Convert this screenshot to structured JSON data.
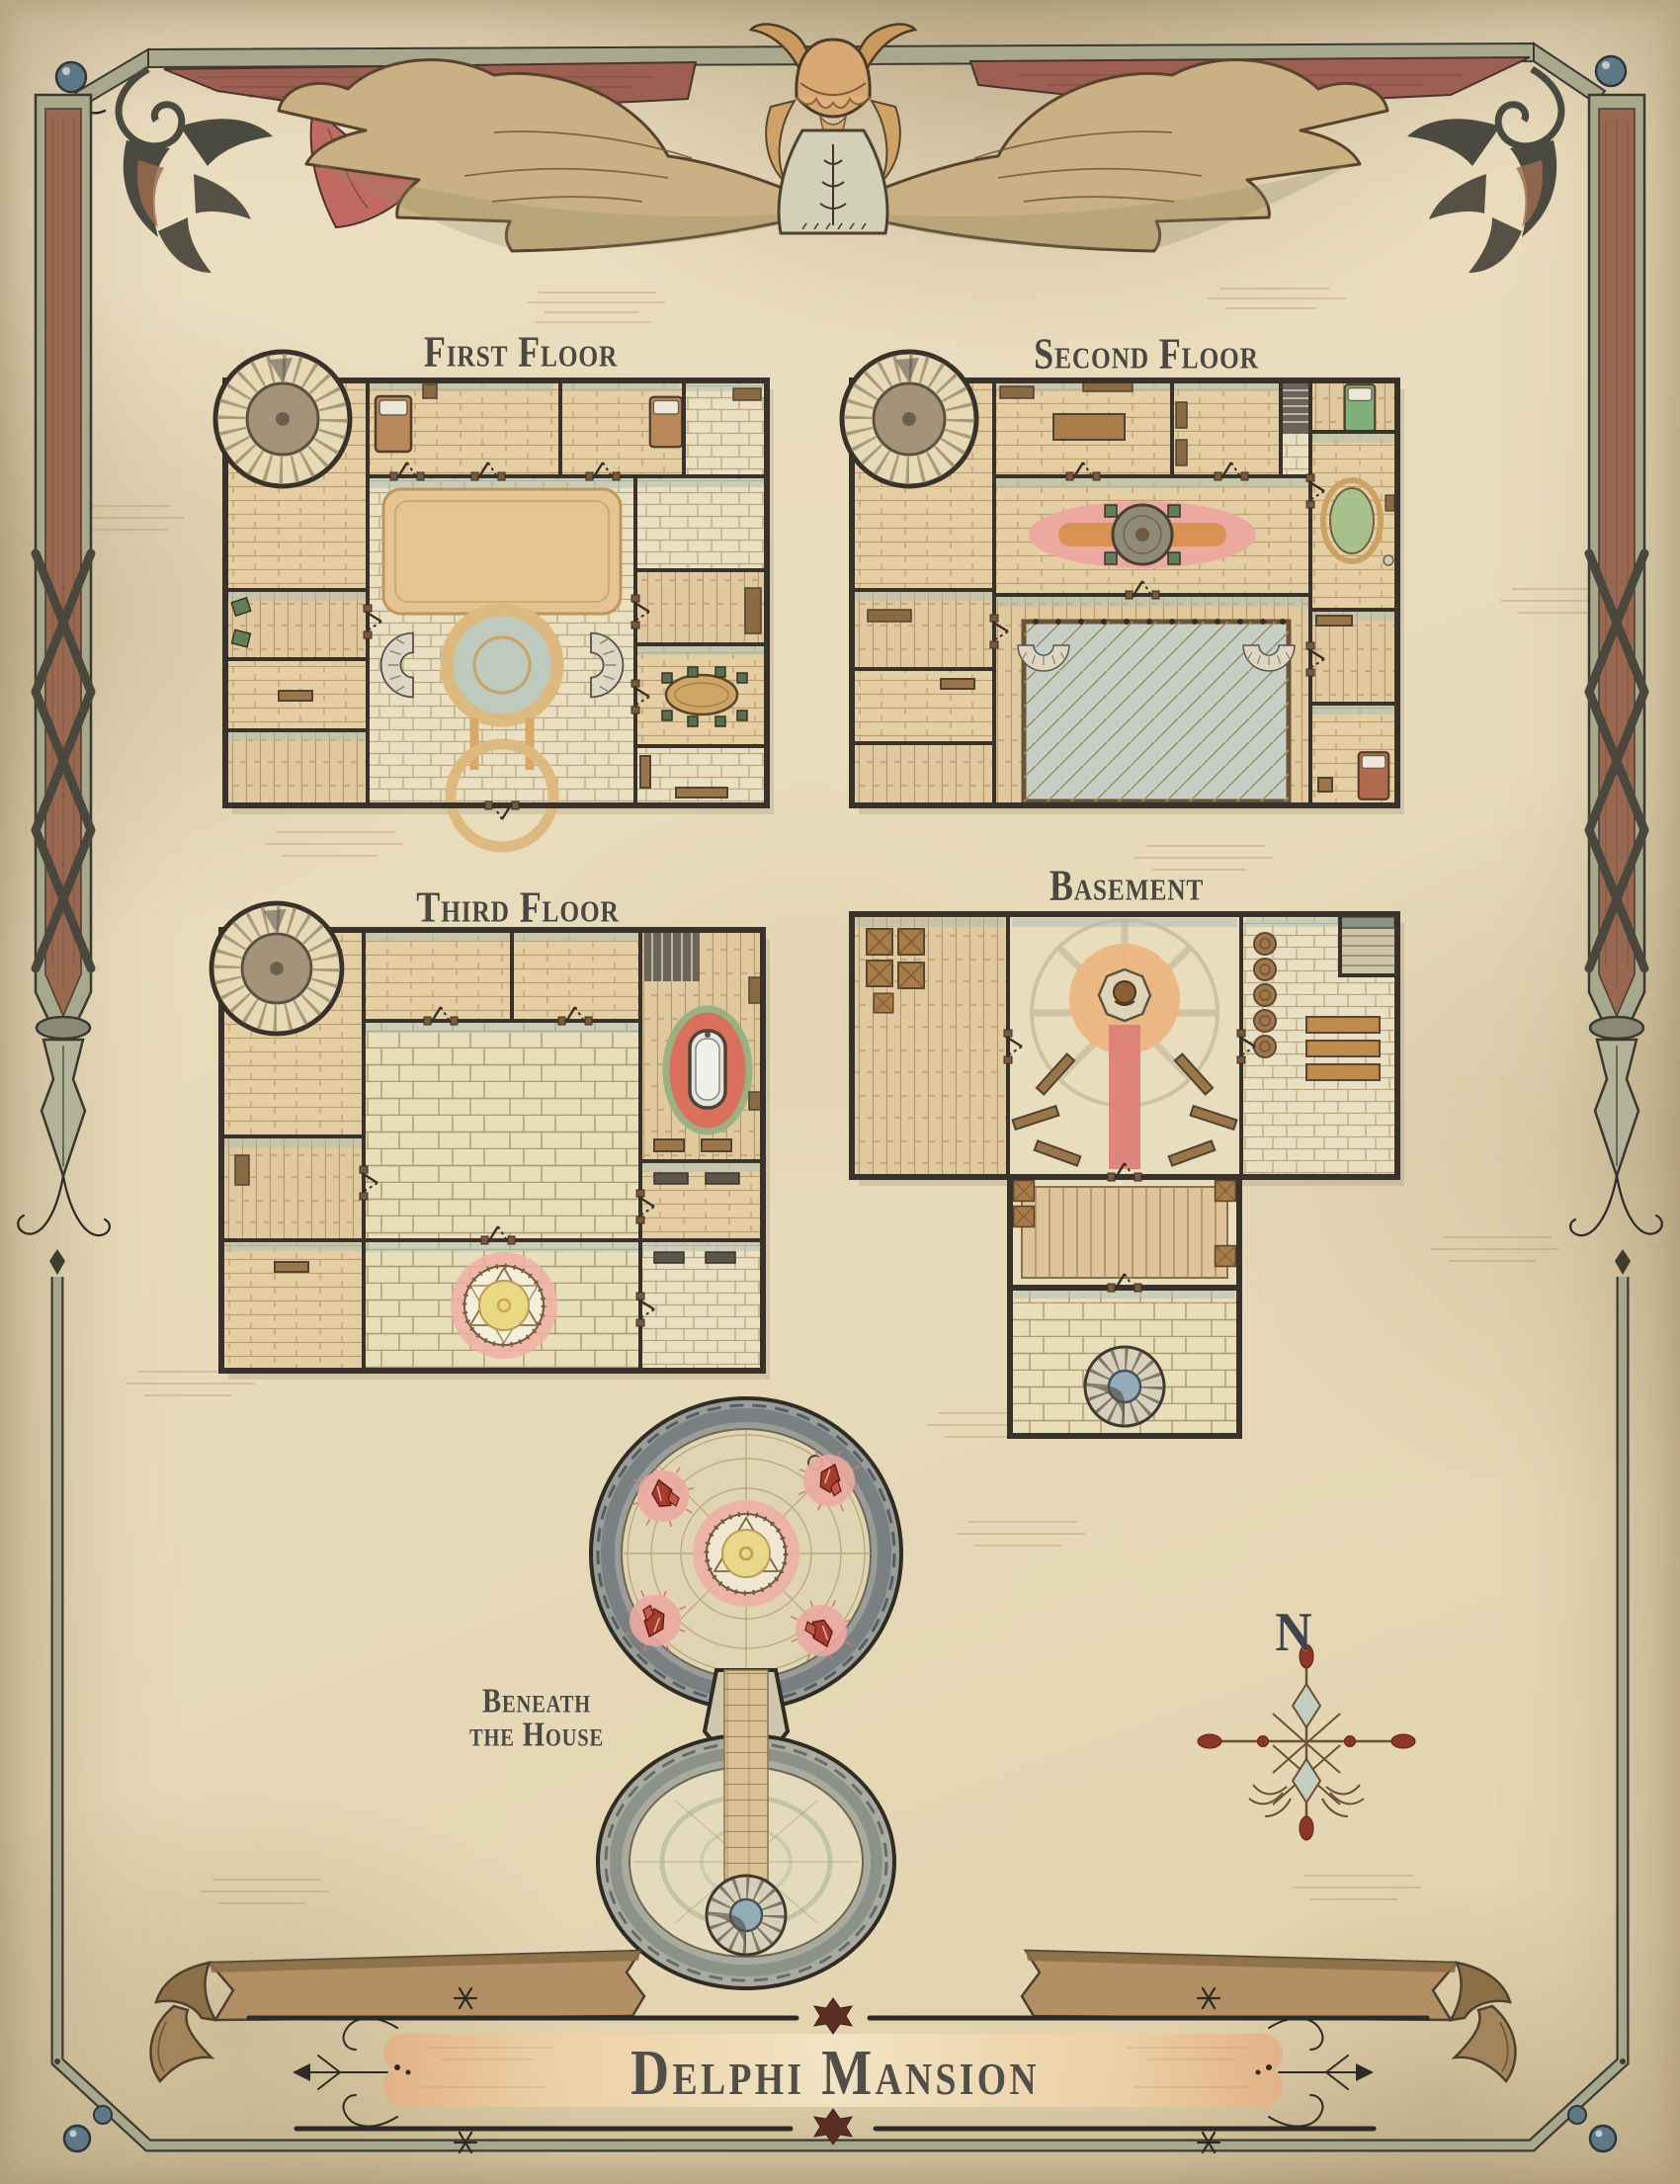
{
  "document": {
    "kind": "fantasy-floorplan-map"
  },
  "banner": {
    "title": "Delphi Mansion"
  },
  "compass": {
    "north_label": "N"
  },
  "floors": [
    {
      "id": "first-floor",
      "label": "First Floor",
      "features": [
        "spiral-stair-tower",
        "bedrooms",
        "grand-foyer",
        "tan-carpet",
        "round-gallery-opening",
        "curved-twin-staircases",
        "dining-room-oval-table",
        "sitting-room-green-chairs"
      ]
    },
    {
      "id": "second-floor",
      "label": "Second Floor",
      "features": [
        "spiral-stair-tower",
        "study-with-table",
        "landing-pink-rug-round-table",
        "open-atrium-overlook",
        "railing-walkway",
        "bathroom-oval-green-tub",
        "bedrooms",
        "stair-nook"
      ]
    },
    {
      "id": "third-floor",
      "label": "Third Floor",
      "features": [
        "spiral-stair-tower",
        "stone-hall",
        "summoning-circle-yellow-pink-glow",
        "bathroom-clawfoot-tub-red-rug",
        "store-rooms",
        "stair-nook"
      ]
    },
    {
      "id": "basement",
      "label": "Basement",
      "features": [
        "crate-storage",
        "shrine-radial-floor",
        "statue-dais",
        "red-runner-carpet",
        "benches",
        "barrel-cellar",
        "stair-corner",
        "wooden-bridge-corridor",
        "stone-vault",
        "spiral-stair-well"
      ]
    },
    {
      "id": "beneath-the-house",
      "label": "Beneath the House",
      "label_line1": "Beneath",
      "label_line2": "the House",
      "features": [
        "crystal-cavern",
        "ritual-circle-runes",
        "four-red-crystal-clusters",
        "rock-rim",
        "neck-passage",
        "lower-cavern",
        "stone-brick-path",
        "spiral-stair-down"
      ]
    }
  ],
  "palette": {
    "paper": "#e7dcc0",
    "ink": "#39322a",
    "label_text": "#4a4841",
    "wood_floor": "#e4cfa4",
    "stone_floor": "#e9dfc2",
    "teal_wash": "#a9beb2",
    "tan_rug": "#e4c491",
    "pink_rug": "#eba9a0",
    "atrium_blue": "#c6cfc6",
    "tub_green": "#a8c08b",
    "bath_rug_red": "#d9705c",
    "ritual_yellow": "#ead984",
    "glow_pink": "#edafa5",
    "crystal_red": "#a63b2e",
    "shrine_orange": "#ecb57f",
    "frame_olive": "#a8a88d",
    "ribbon_red": "#9c5f52",
    "sash_red": "#c16a62",
    "banner_brown": "#b29064",
    "orb_blue": "#5e7886",
    "compass_red": "#8c3627"
  }
}
